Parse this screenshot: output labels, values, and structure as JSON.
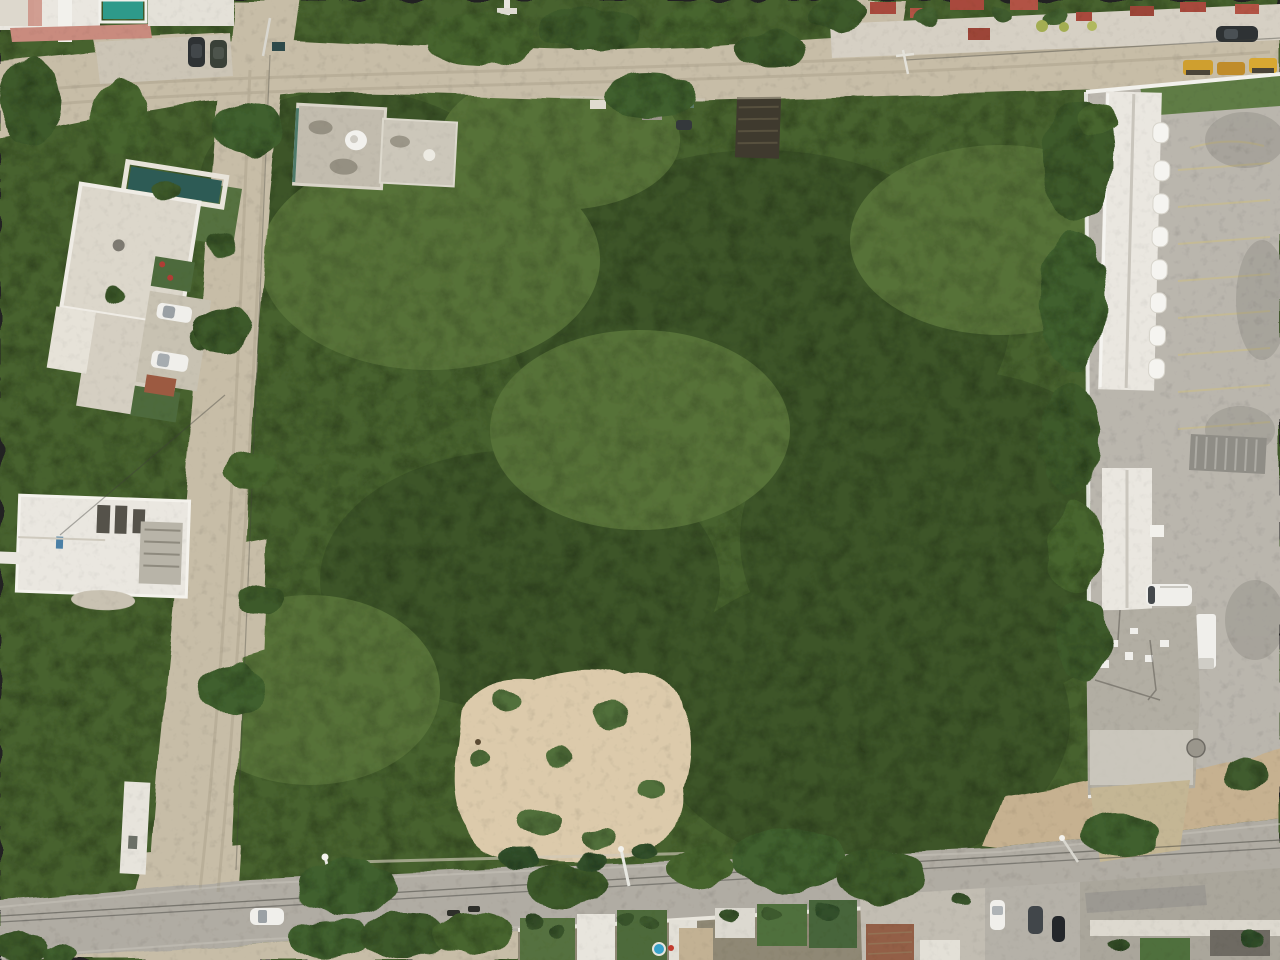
{
  "scene": {
    "type": "aerial-drone-photograph",
    "view": "top-down nadir view",
    "subject": "Undeveloped forested land parcel bounded by dirt roads and a paved street, with houses to the left and top, a commercial compound with parking lot to the right, and a row of homes along the bottom street",
    "lighting": "overcast daylight"
  },
  "colors": {
    "forest_base": "#47622f",
    "forest_shadow": "#1c2a15",
    "forest_light": "#8dab5f",
    "dirt_road": "#c7bda7",
    "paved_road": "#b0aca3",
    "concrete": "#bab6ad",
    "sand_clearing": "#dccaab",
    "embankment_sand": "#c6b190",
    "building_white": "#eae7e0",
    "roof_weathered": "#c2bcae",
    "roof_grey": "#9c9992",
    "pool_teal": "#2e9a8a",
    "lap_pool_dark": "#2d5b55",
    "terrace_pink": "#c98b7e",
    "red_roof": "#a84a3c",
    "brick": "#935f46",
    "grass_yard": "#55713f",
    "hedge_yellow": "#a3ad52",
    "machine_yellow": "#cf9f2f",
    "vehicle_dark": "#2e3234",
    "vehicle_white": "#f0efeb",
    "kiddie_pool_blue": "#3aa2c9",
    "metal_grey": "#8f8d86",
    "shack_dark": "#3f3a2e",
    "wall_white": "#f2f1ec"
  },
  "regions": {
    "forest_parcel": "dense mixed tree canopy covering the central parcel",
    "sand_clearing": "bare sandy clearing with scattered bushes inside the parcel, lower center-left",
    "top_dirt_road": "sandy dirt road running along the top with a side branch near the right junction",
    "left_dirt_road": "sandy dirt road running diagonally down the left side",
    "bottom_paved_road": "grey paved street along the bottom with power lines and street lamps",
    "right_compound": "commercial compound with long white awning building, striped parking lot, flat roofs and service vehicles",
    "top_left_houses": "white flat-roof houses with swimming pools at the top-left corner",
    "pool_house": "white villa with dark lap pool, palms and two parked white cars, upper left",
    "construction_house": "white house under construction beside the left road, middle left",
    "satellite_house": "weathered two-block rooftop with satellite dish at the top edge of the parcel",
    "dark_shack": "dark-roofed shack just inside the parcel near the top",
    "top_right_houses": "row of houses with red tile roofs and a parked dark SUV along the top right",
    "bottom_houses": "row of walled homes with green yards, palms, a kiddie pool and a brick outbuilding below the bottom street",
    "embankment": "sandy stone embankment above the bottom street at the right"
  },
  "objects": {
    "vehicles": [
      "two dark SUVs parked side by side near the top-left junction",
      "two white cars in the pool-house driveway",
      "dark SUV parked on the top-right street",
      "three yellow construction machines top-right corner",
      "white shuttle bus and white box truck in the right compound",
      "white car driving on the bottom street",
      "two parked motorcycles on the bottom street",
      "white, grey and black cars parked below the bottom street"
    ],
    "infrastructure": [
      "power poles and overhead lines along the roads",
      "street lamps on the bottom street",
      "satellite dish on rooftop",
      "yellow-striped parking bays in the right compound"
    ]
  }
}
